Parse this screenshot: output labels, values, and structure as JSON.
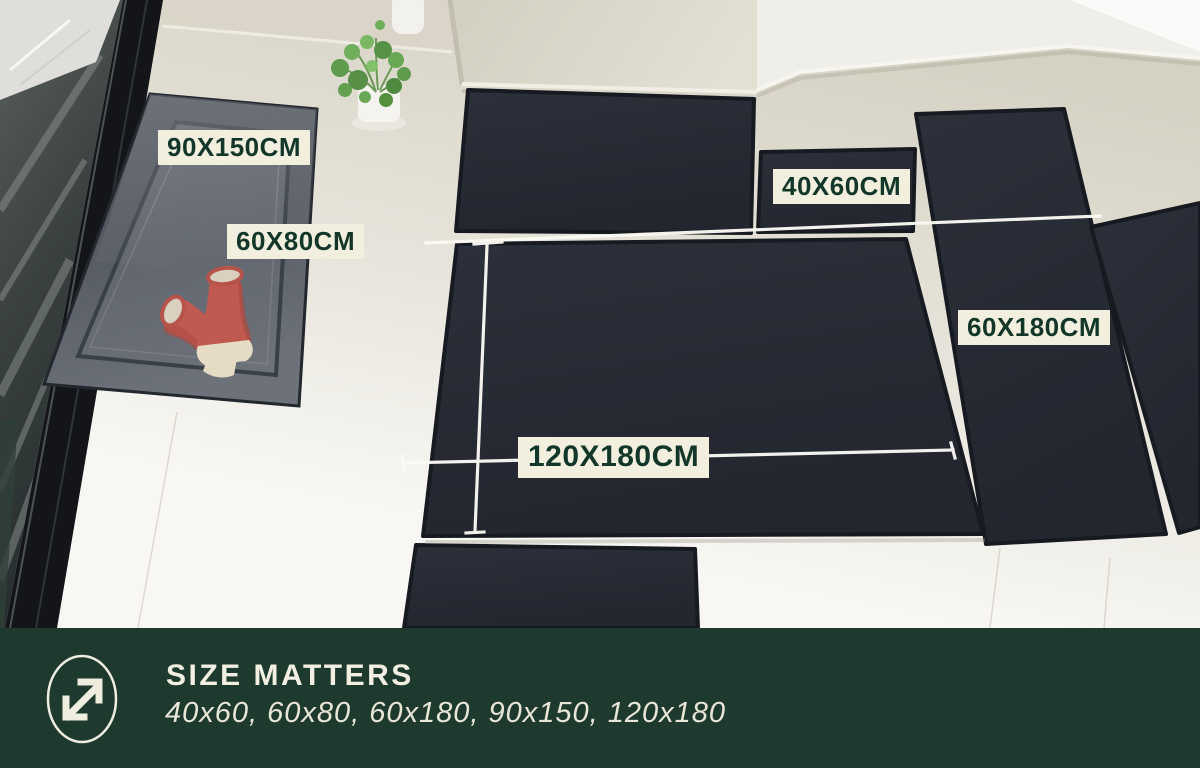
{
  "size_labels": {
    "mat_90x150": "90X150CM",
    "mat_60x80": "60X80CM",
    "mat_40x60": "40X60CM",
    "mat_60x180": "60X180CM",
    "mat_120x180": "120X180CM"
  },
  "banner": {
    "title": "SIZE MATTERS",
    "subtitle": "40x60, 60x80, 60x180, 90x150, 120x180",
    "icon": "resize-diagonal-icon"
  },
  "colors": {
    "banner_bg": "#1e3a2f",
    "banner_text": "#f3f0e3",
    "label_bg": "#f2efde",
    "label_text": "#12372a",
    "mat_dark": "#272b34",
    "floor_light": "#f8f7f3",
    "floor_dark": "#d5d1c3",
    "boot_red": "#c05a50",
    "plant_green": "#5e9b4c",
    "measure_line": "#fbfaf4"
  }
}
